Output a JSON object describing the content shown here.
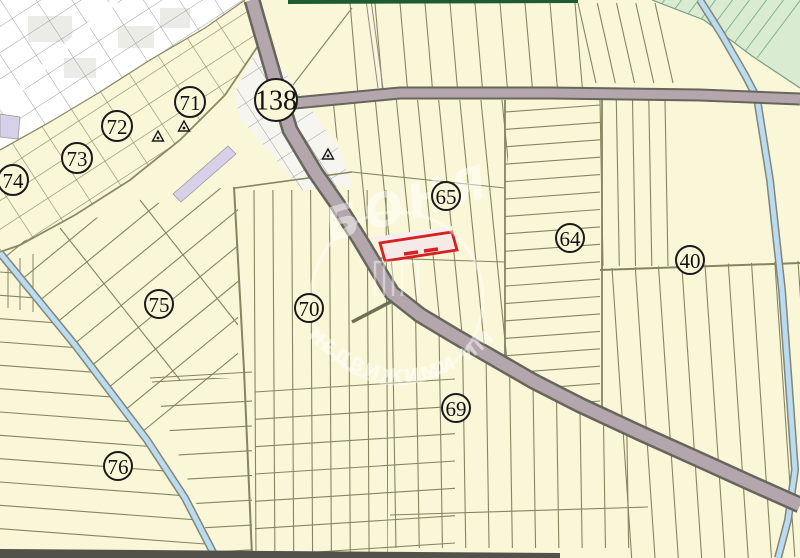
{
  "map": {
    "colors": {
      "background": "#faf7d9",
      "parcel_line": "#85855f",
      "block_line": "#73735a",
      "road_fill": "#b3a6ac",
      "road_casing": "#66665c",
      "water_fill": "#badcf0",
      "water_casing": "#84847a",
      "urban_fill": "#ffffff",
      "urban_line": "#a0a09a",
      "green_fill": "#d9ecd2",
      "highlight_stroke": "#d62121",
      "highlight_fill": "#f6eae8",
      "marker_ink": "#1a1a1a",
      "lavender_fill": "#d8d0e8",
      "top_band": "#1e5c30",
      "bottom_band": "#52524a"
    },
    "markers": [
      {
        "label": "138",
        "x": 276,
        "y": 100,
        "r": 21,
        "large": true
      },
      {
        "label": "71",
        "x": 190,
        "y": 102,
        "r": 15
      },
      {
        "label": "72",
        "x": 117,
        "y": 126,
        "r": 15
      },
      {
        "label": "73",
        "x": 77,
        "y": 158,
        "r": 15
      },
      {
        "label": "74",
        "x": 13,
        "y": 180,
        "r": 15
      },
      {
        "label": "75",
        "x": 159,
        "y": 304,
        "r": 14
      },
      {
        "label": "76",
        "x": 118,
        "y": 466,
        "r": 14
      },
      {
        "label": "70",
        "x": 309,
        "y": 308,
        "r": 14
      },
      {
        "label": "65",
        "x": 446,
        "y": 196,
        "r": 14
      },
      {
        "label": "64",
        "x": 570,
        "y": 238,
        "r": 14
      },
      {
        "label": "40",
        "x": 690,
        "y": 260,
        "r": 14
      },
      {
        "label": "69",
        "x": 456,
        "y": 408,
        "r": 14
      }
    ],
    "survey_points": [
      {
        "x": 158,
        "y": 137
      },
      {
        "x": 184,
        "y": 127
      },
      {
        "x": 328,
        "y": 155
      }
    ],
    "watermark": {
      "top_text": "БОНЯ",
      "bottom_text": "НЕДВИЖИМИ ИМОТИ"
    }
  }
}
